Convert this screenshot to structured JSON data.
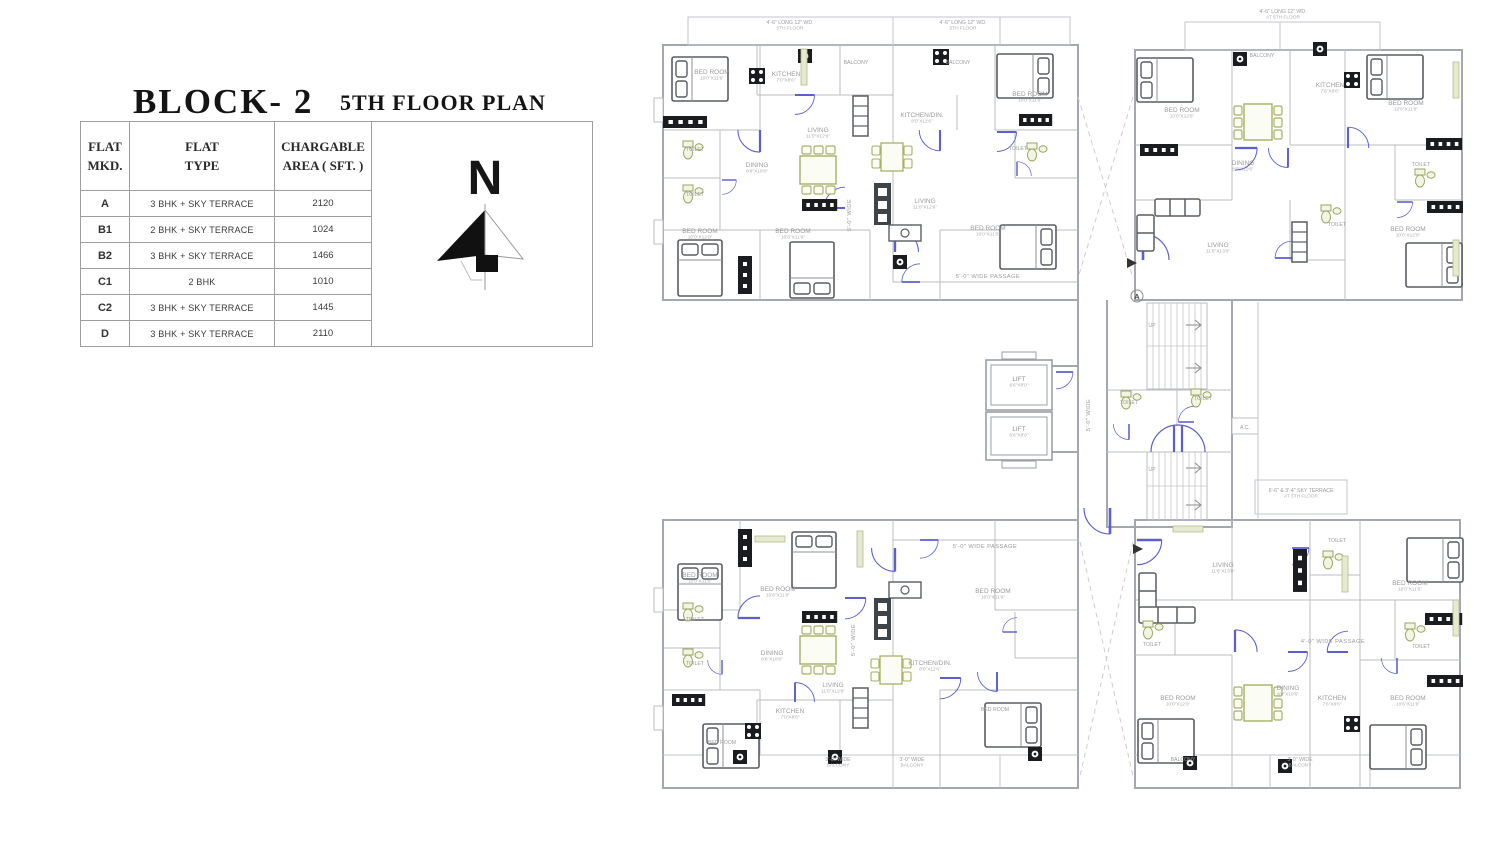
{
  "title": {
    "block": "BLOCK- 2",
    "floor": "5TH FLOOR PLAN"
  },
  "compass": {
    "label": "N"
  },
  "table": {
    "headers": {
      "c1a": "FLAT",
      "c1b": "MKD.",
      "c2a": "FLAT",
      "c2b": "TYPE",
      "c3a": "CHARGABLE",
      "c3b": "AREA ( SFT. )"
    },
    "rows": [
      {
        "flat": "A",
        "type": "3 BHK + SKY TERRACE",
        "area": "2120"
      },
      {
        "flat": "B1",
        "type": "2 BHK + SKY TERRACE",
        "area": "1024"
      },
      {
        "flat": "B2",
        "type": "3 BHK + SKY TERRACE",
        "area": "1466"
      },
      {
        "flat": "C1",
        "type": "2 BHK",
        "area": "1010"
      },
      {
        "flat": "C2",
        "type": "3 BHK + SKY TERRACE",
        "area": "1445"
      },
      {
        "flat": "D",
        "type": "3 BHK + SKY TERRACE",
        "area": "2110"
      }
    ]
  },
  "plan": {
    "colors": {
      "door": "#5d5fd0",
      "wall": "#a3a8af",
      "furniture": "#585d63",
      "olive": "#a8b065",
      "fixture_black": "#1a1c1f",
      "label": "#9b9b9b"
    },
    "labels": [
      {
        "x": 790,
        "y": 24,
        "t": "4'-6\" LONG 12\" WD.",
        "d": "5TH FLOOR",
        "c": "note"
      },
      {
        "x": 963,
        "y": 24,
        "t": "4'-6\" LONG 12\" WD.",
        "d": "5TH FLOOR",
        "c": "note"
      },
      {
        "x": 1283,
        "y": 13,
        "t": "4'-6\" LONG 12\" WD.",
        "d": "AT 5TH FLOOR",
        "c": "note"
      },
      {
        "x": 1301,
        "y": 492,
        "t": "6'-6\" & 3'-4\" SKY TERRACE",
        "d": "AT 5TH FLOOR",
        "c": "note"
      },
      {
        "x": 988,
        "y": 278,
        "t": "5'-0\" WIDE PASSAGE",
        "c": "passage"
      },
      {
        "x": 985,
        "y": 548,
        "t": "5'-0\" WIDE PASSAGE",
        "c": "passage"
      },
      {
        "x": 1090,
        "y": 415,
        "t": "5'-0\" WIDE",
        "r": -90,
        "c": "passage"
      },
      {
        "x": 851,
        "y": 215,
        "t": "5'-0\" WIDE",
        "r": -90,
        "c": "passage"
      },
      {
        "x": 855,
        "y": 640,
        "t": "5'-0\" WIDE",
        "r": -90,
        "c": "passage"
      },
      {
        "x": 1333,
        "y": 643,
        "t": "4'-0\" WIDE PASSAGE",
        "c": "passage"
      },
      {
        "x": 712,
        "y": 74,
        "t": "BED ROOM",
        "d": "10'0\"X11'6\""
      },
      {
        "x": 786,
        "y": 76,
        "t": "KITCHEN",
        "d": "7'0\"X8'6\""
      },
      {
        "x": 856,
        "y": 64,
        "t": "BALCONY",
        "c": "tiny"
      },
      {
        "x": 695,
        "y": 151,
        "t": "TOILET",
        "c": "tiny"
      },
      {
        "x": 695,
        "y": 196,
        "t": "TOILET",
        "c": "tiny"
      },
      {
        "x": 818,
        "y": 132,
        "t": "LIVING",
        "d": "11'0\"X12'6\""
      },
      {
        "x": 757,
        "y": 167,
        "t": "DINING",
        "d": "8'6\"X10'0\""
      },
      {
        "x": 700,
        "y": 233,
        "t": "BED ROOM",
        "d": "10'0\"X12'0\""
      },
      {
        "x": 793,
        "y": 233,
        "t": "BED ROOM",
        "d": "10'6\"X11'0\""
      },
      {
        "x": 922,
        "y": 117,
        "t": "KITCHEN/DIN.",
        "d": "8'0\"X11'6\""
      },
      {
        "x": 958,
        "y": 64,
        "t": "BALCONY",
        "c": "tiny"
      },
      {
        "x": 1030,
        "y": 96,
        "t": "BED ROOM",
        "d": "10'0\"X11'6\""
      },
      {
        "x": 1018,
        "y": 150,
        "t": "TOILET",
        "c": "tiny"
      },
      {
        "x": 925,
        "y": 203,
        "t": "LIVING",
        "d": "11'0\"X12'6\""
      },
      {
        "x": 988,
        "y": 230,
        "t": "BED ROOM",
        "d": "10'0\"X11'0\""
      },
      {
        "x": 1182,
        "y": 112,
        "t": "BED ROOM",
        "d": "10'0\"X12'6\""
      },
      {
        "x": 1243,
        "y": 165,
        "t": "DINING",
        "d": "8'0\"X10'6\""
      },
      {
        "x": 1330,
        "y": 87,
        "t": "KITCHEN",
        "d": "7'6\"X8'6\""
      },
      {
        "x": 1406,
        "y": 105,
        "t": "BED ROOM",
        "d": "10'6\"X11'6\""
      },
      {
        "x": 1262,
        "y": 57,
        "t": "BALCONY",
        "c": "tiny"
      },
      {
        "x": 1421,
        "y": 166,
        "t": "TOILET",
        "c": "tiny"
      },
      {
        "x": 1337,
        "y": 226,
        "t": "TOILET",
        "c": "tiny"
      },
      {
        "x": 1218,
        "y": 247,
        "t": "LIVING",
        "d": "11'6\"X13'0\""
      },
      {
        "x": 1408,
        "y": 231,
        "t": "BED ROOM",
        "d": "10'0\"X12'0\""
      },
      {
        "x": 1019,
        "y": 381,
        "t": "LIFT",
        "d": "6'6\"X8'0\"",
        "c": "lift"
      },
      {
        "x": 1019,
        "y": 431,
        "t": "LIFT",
        "d": "6'6\"X8'0\"",
        "c": "lift"
      },
      {
        "x": 1129,
        "y": 404,
        "t": "TOILET",
        "c": "tiny"
      },
      {
        "x": 1203,
        "y": 400,
        "t": "TOILET",
        "c": "tiny"
      },
      {
        "x": 1152,
        "y": 327,
        "t": "UP",
        "c": "tiny"
      },
      {
        "x": 1152,
        "y": 471,
        "t": "UP",
        "c": "tiny"
      },
      {
        "x": 1245,
        "y": 429,
        "t": "A.C.",
        "c": "tiny"
      },
      {
        "x": 1137,
        "y": 299,
        "t": "A",
        "c": "marker"
      },
      {
        "x": 700,
        "y": 577,
        "t": "BED ROOM",
        "d": "10'0\"X11'6\""
      },
      {
        "x": 778,
        "y": 591,
        "t": "BED ROOM",
        "d": "10'6\"X11'0\""
      },
      {
        "x": 695,
        "y": 621,
        "t": "TOILET",
        "c": "tiny"
      },
      {
        "x": 695,
        "y": 665,
        "t": "TOILET",
        "c": "tiny"
      },
      {
        "x": 772,
        "y": 655,
        "t": "DINING",
        "d": "8'6\"X10'0\""
      },
      {
        "x": 833,
        "y": 687,
        "t": "LIVING",
        "d": "11'0\"X12'6\""
      },
      {
        "x": 722,
        "y": 744,
        "t": "BED ROOM",
        "c": "tiny"
      },
      {
        "x": 790,
        "y": 713,
        "t": "KITCHEN",
        "d": "7'0\"X8'6\""
      },
      {
        "x": 930,
        "y": 665,
        "t": "KITCHEN/DIN.",
        "d": "8'0\"X11'6\""
      },
      {
        "x": 993,
        "y": 593,
        "t": "BED ROOM",
        "d": "10'0\"X11'0\""
      },
      {
        "x": 995,
        "y": 711,
        "t": "BED ROOM",
        "c": "tiny"
      },
      {
        "x": 838,
        "y": 761,
        "t": "3'-0\" WIDE",
        "d": "BALCONY",
        "c": "note"
      },
      {
        "x": 912,
        "y": 761,
        "t": "3'-0\" WIDE",
        "d": "BALCONY",
        "c": "note"
      },
      {
        "x": 1223,
        "y": 567,
        "t": "LIVING",
        "d": "11'6\"X13'0\""
      },
      {
        "x": 1337,
        "y": 542,
        "t": "TOILET",
        "c": "tiny"
      },
      {
        "x": 1410,
        "y": 585,
        "t": "BED ROOM",
        "d": "10'0\"X11'6\""
      },
      {
        "x": 1152,
        "y": 646,
        "t": "TOILET",
        "c": "tiny"
      },
      {
        "x": 1421,
        "y": 648,
        "t": "TOILET",
        "c": "tiny"
      },
      {
        "x": 1288,
        "y": 690,
        "t": "DINING",
        "d": "8'0\"X10'6\""
      },
      {
        "x": 1178,
        "y": 700,
        "t": "BED ROOM",
        "d": "10'0\"X12'0\""
      },
      {
        "x": 1408,
        "y": 700,
        "t": "BED ROOM",
        "d": "10'6\"X11'6\""
      },
      {
        "x": 1332,
        "y": 700,
        "t": "KITCHEN",
        "d": "7'6\"X8'6\""
      },
      {
        "x": 1183,
        "y": 761,
        "t": "BALCONY",
        "c": "tiny"
      },
      {
        "x": 1300,
        "y": 761,
        "t": "3'-0\" WIDE",
        "d": "BALCONY",
        "c": "note"
      }
    ]
  }
}
